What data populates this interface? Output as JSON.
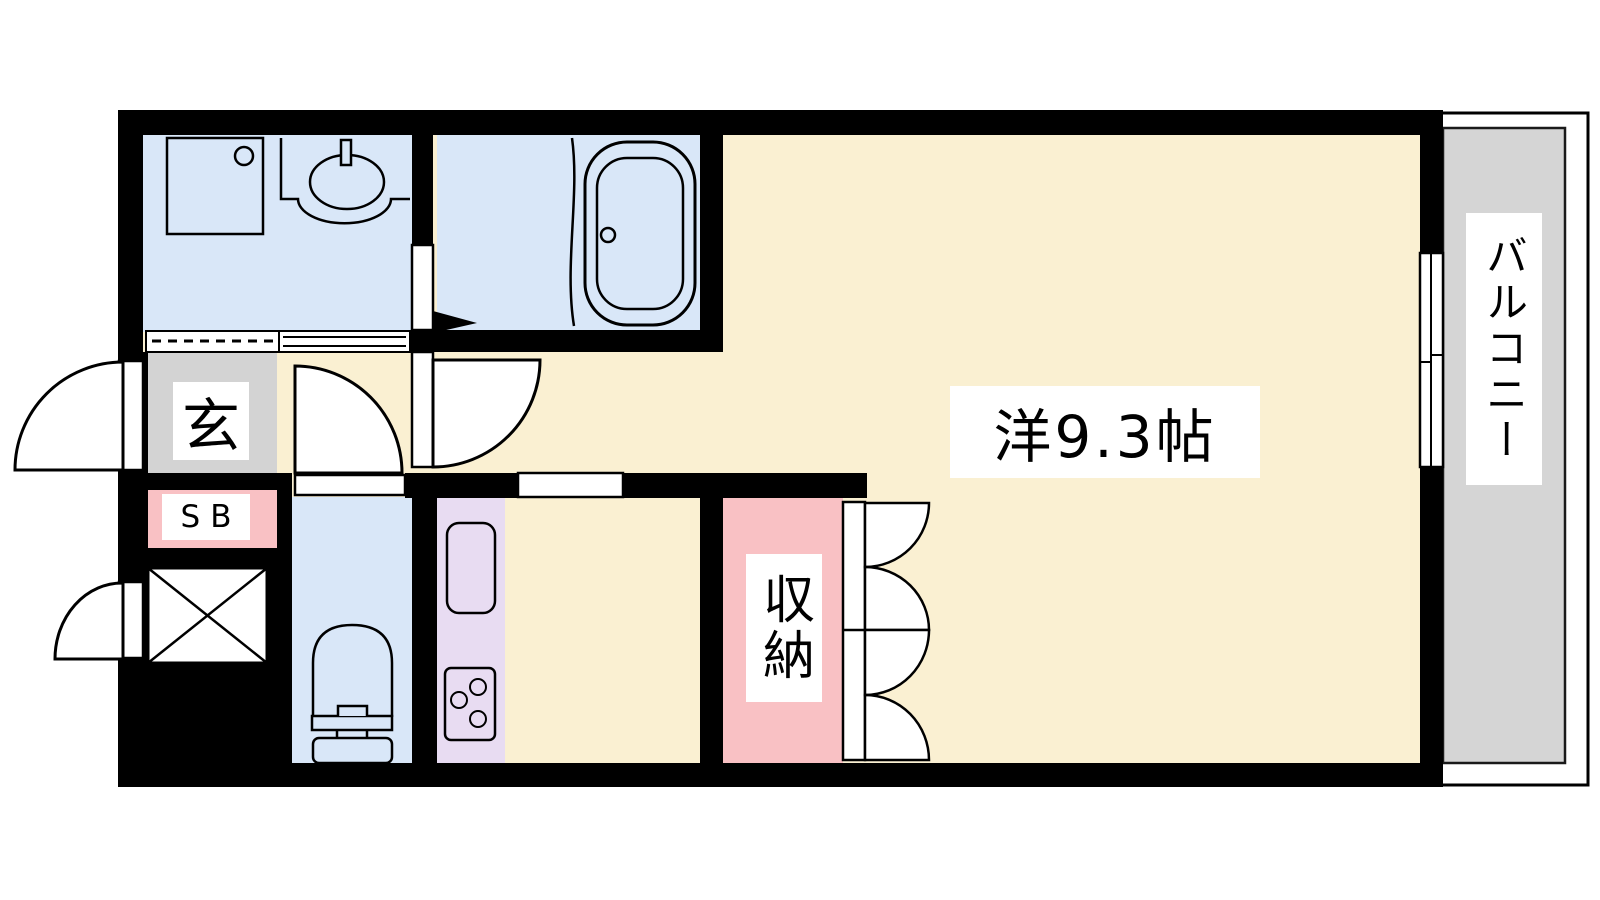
{
  "floorplan": {
    "labels": {
      "entrance": "玄",
      "shoe_box": "SB",
      "storage": "収納",
      "main_room": "洋9.3帖",
      "balcony": "バルコニー"
    },
    "colors": {
      "floor_cream": "#FAF0D2",
      "wet_area_blue": "#D9E7F8",
      "kitchen_lavender": "#E8DCF2",
      "closet_pink": "#F9C1C4",
      "entrance_gray": "#D3D3D3",
      "balcony_gray": "#D5D5D5",
      "wall": "#000000"
    }
  }
}
